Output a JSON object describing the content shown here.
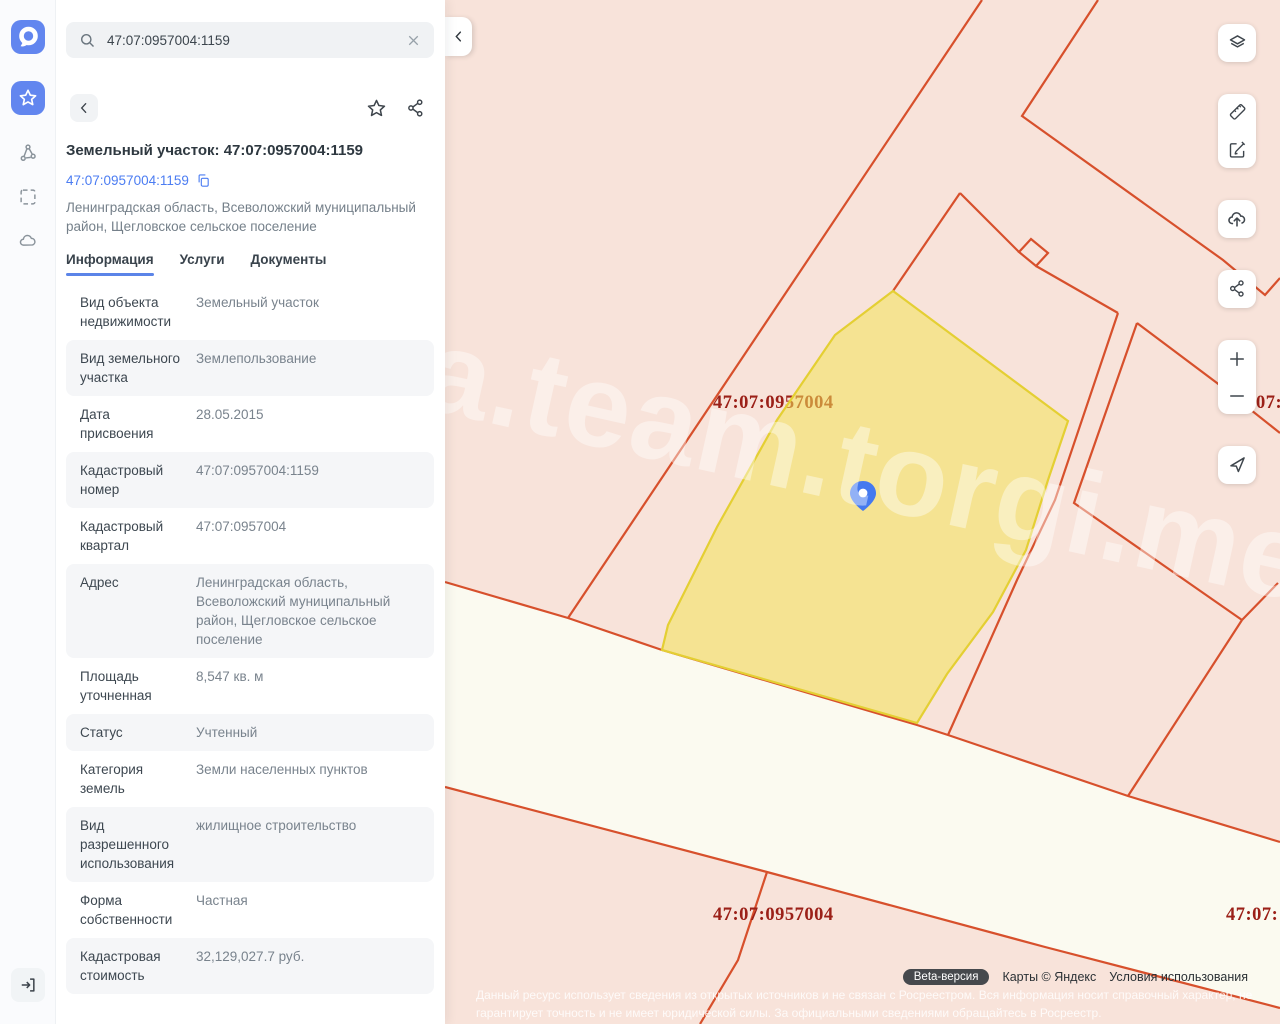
{
  "sidebar": {
    "icons": [
      "app-logo",
      "favorites-star",
      "graph-nodes",
      "select-area",
      "cloud",
      "sign-in"
    ]
  },
  "search": {
    "value": "47:07:0957004:1159"
  },
  "detail": {
    "title": "Земельный участок: 47:07:0957004:1159",
    "cadastral_link": "47:07:0957004:1159",
    "address": "Ленинградская область, Всеволожский муниципальный район, Щегловское сельское поселение",
    "tabs": [
      {
        "label": "Информация",
        "active": true
      },
      {
        "label": "Услуги",
        "active": false
      },
      {
        "label": "Документы",
        "active": false
      }
    ],
    "rows": [
      {
        "label": "Вид объекта недвижимости",
        "value": "Земельный участок"
      },
      {
        "label": "Вид земельного участка",
        "value": "Землепользование"
      },
      {
        "label": "Дата присвоения",
        "value": "28.05.2015"
      },
      {
        "label": "Кадастровый номер",
        "value": "47:07:0957004:1159"
      },
      {
        "label": "Кадастровый квартал",
        "value": "47:07:0957004"
      },
      {
        "label": "Адрес",
        "value": "Ленинградская область, Всеволожский муниципальный район, Щегловское сельское поселение"
      },
      {
        "label": "Площадь уточненная",
        "value": "8,547 кв. м"
      },
      {
        "label": "Статус",
        "value": "Учтенный"
      },
      {
        "label": "Категория земель",
        "value": "Земли населенных пунктов"
      },
      {
        "label": "Вид разрешенного использования",
        "value": "жилищное строительство"
      },
      {
        "label": "Форма собственности",
        "value": "Частная"
      },
      {
        "label": "Кадастровая стоимость",
        "value": "32,129,027.7 руб."
      }
    ]
  },
  "map": {
    "quarter_labels": [
      "47:07:0957004",
      "47:07:0957004",
      "07:",
      "47:07:"
    ],
    "watermark": "a.team.torgi.me",
    "attribution": {
      "beta": "Beta-версия",
      "provider": "Карты © Яндекс",
      "terms": "Условия использования"
    },
    "disclaimer": "Данный ресурс использует сведения из открытых источников и не связан с Росреестром. Вся информация носит справочный характер, не гарантирует точность и не имеет юридической силы. За официальными сведениями обращайтесь в Росреестр.",
    "colors": {
      "map_bg": "#f8e3da",
      "road": "#fbfaf0",
      "parcel_line": "#d7502c",
      "highlight_fill": "#f3e458",
      "highlight_stroke": "#e4cf33",
      "quarter_label": "#9b2018",
      "accent": "#5b84e8",
      "pin": "#4479ef"
    }
  }
}
